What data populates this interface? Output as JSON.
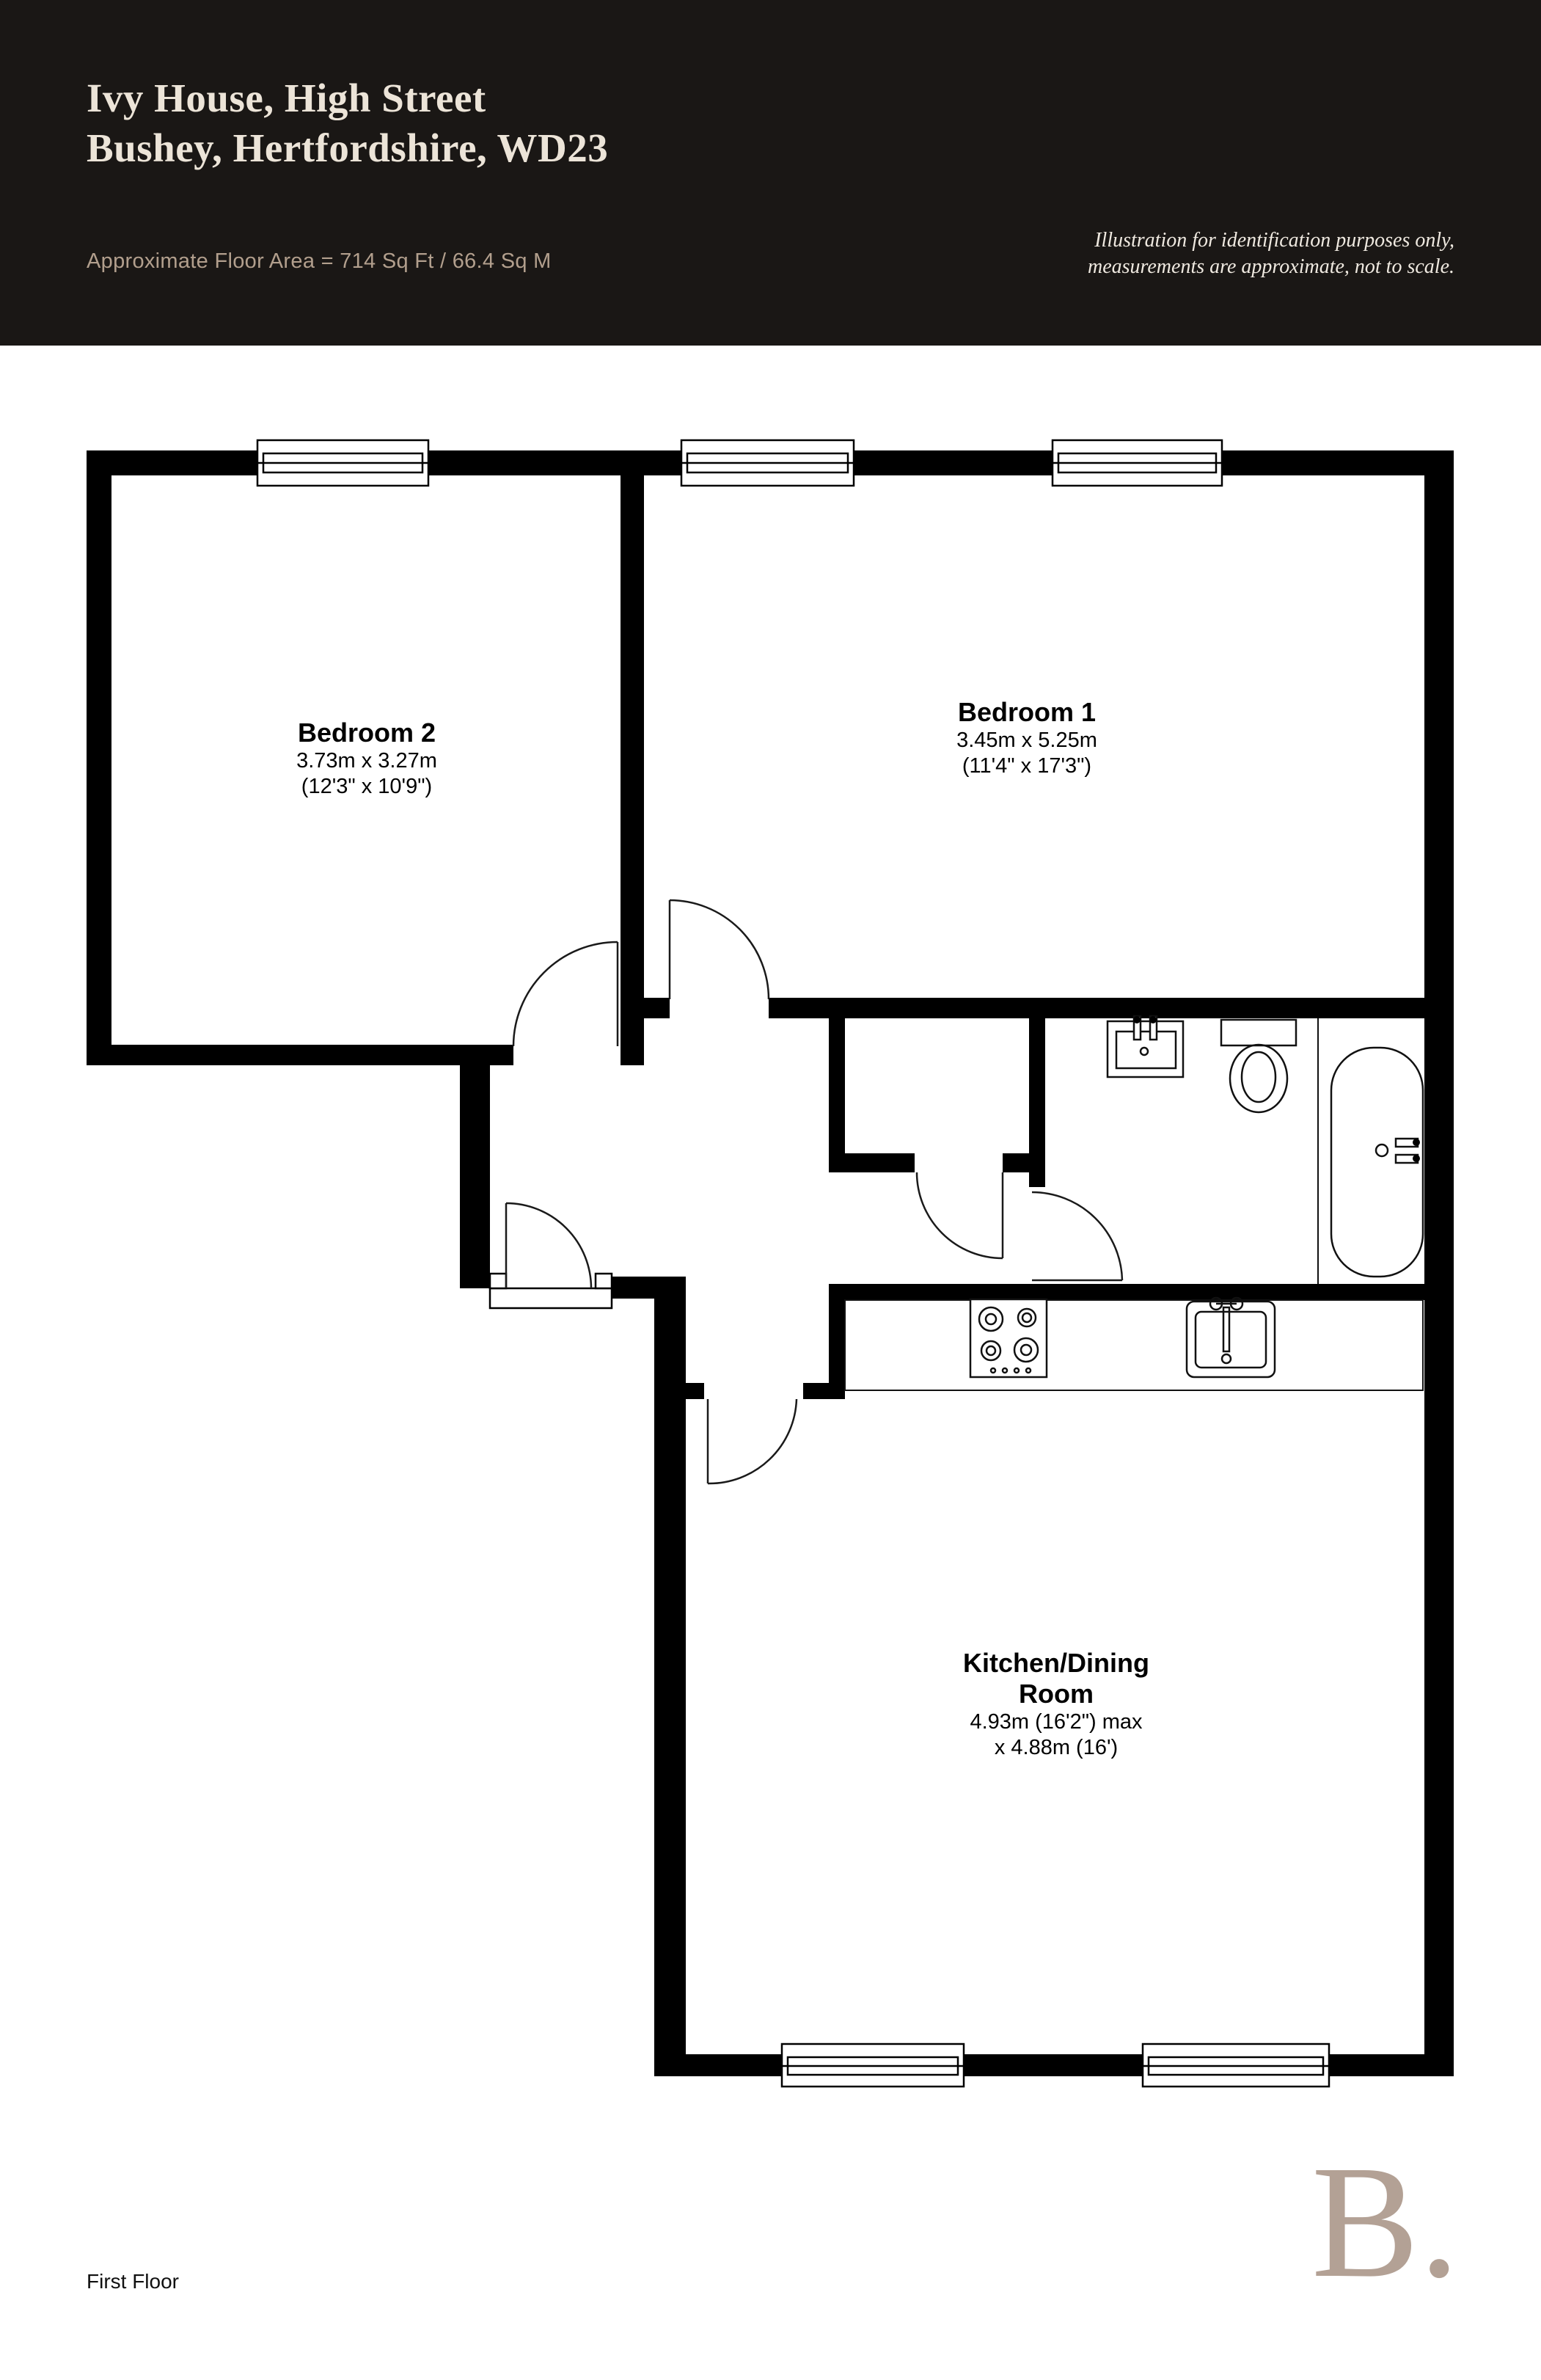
{
  "header": {
    "title_line1": "Ivy House, High Street",
    "title_line2": "Bushey, Hertfordshire, WD23",
    "floor_area": "Approximate Floor Area = 714 Sq Ft / 66.4 Sq M",
    "disclaimer_line1": "Illustration for identification purposes only,",
    "disclaimer_line2": "measurements are approximate, not to scale.",
    "bg_color": "#1a1715",
    "title_color": "#ece4d8",
    "area_color": "#b29f8d"
  },
  "rooms": {
    "bedroom2": {
      "name": "Bedroom 2",
      "dim_metric": "3.73m x 3.27m",
      "dim_imperial": "(12'3\" x 10'9\")"
    },
    "bedroom1": {
      "name": "Bedroom 1",
      "dim_metric": "3.45m x 5.25m",
      "dim_imperial": "(11'4\" x 17'3\")"
    },
    "kitchen": {
      "name_line1": "Kitchen/Dining",
      "name_line2": "Room",
      "dim_line1": "4.93m (16'2\") max",
      "dim_line2": "x 4.88m (16')"
    }
  },
  "plan": {
    "wall_color": "#000000",
    "fixture_icons": [
      "window-icon",
      "door-icon",
      "bath-icon",
      "toilet-icon",
      "bathroom-sink-icon",
      "kitchen-sink-icon",
      "hob-icon",
      "entrance-threshold-icon"
    ]
  },
  "footer": {
    "floor_label": "First Floor",
    "logo_text": "B.",
    "logo_color": "#b3a195"
  }
}
